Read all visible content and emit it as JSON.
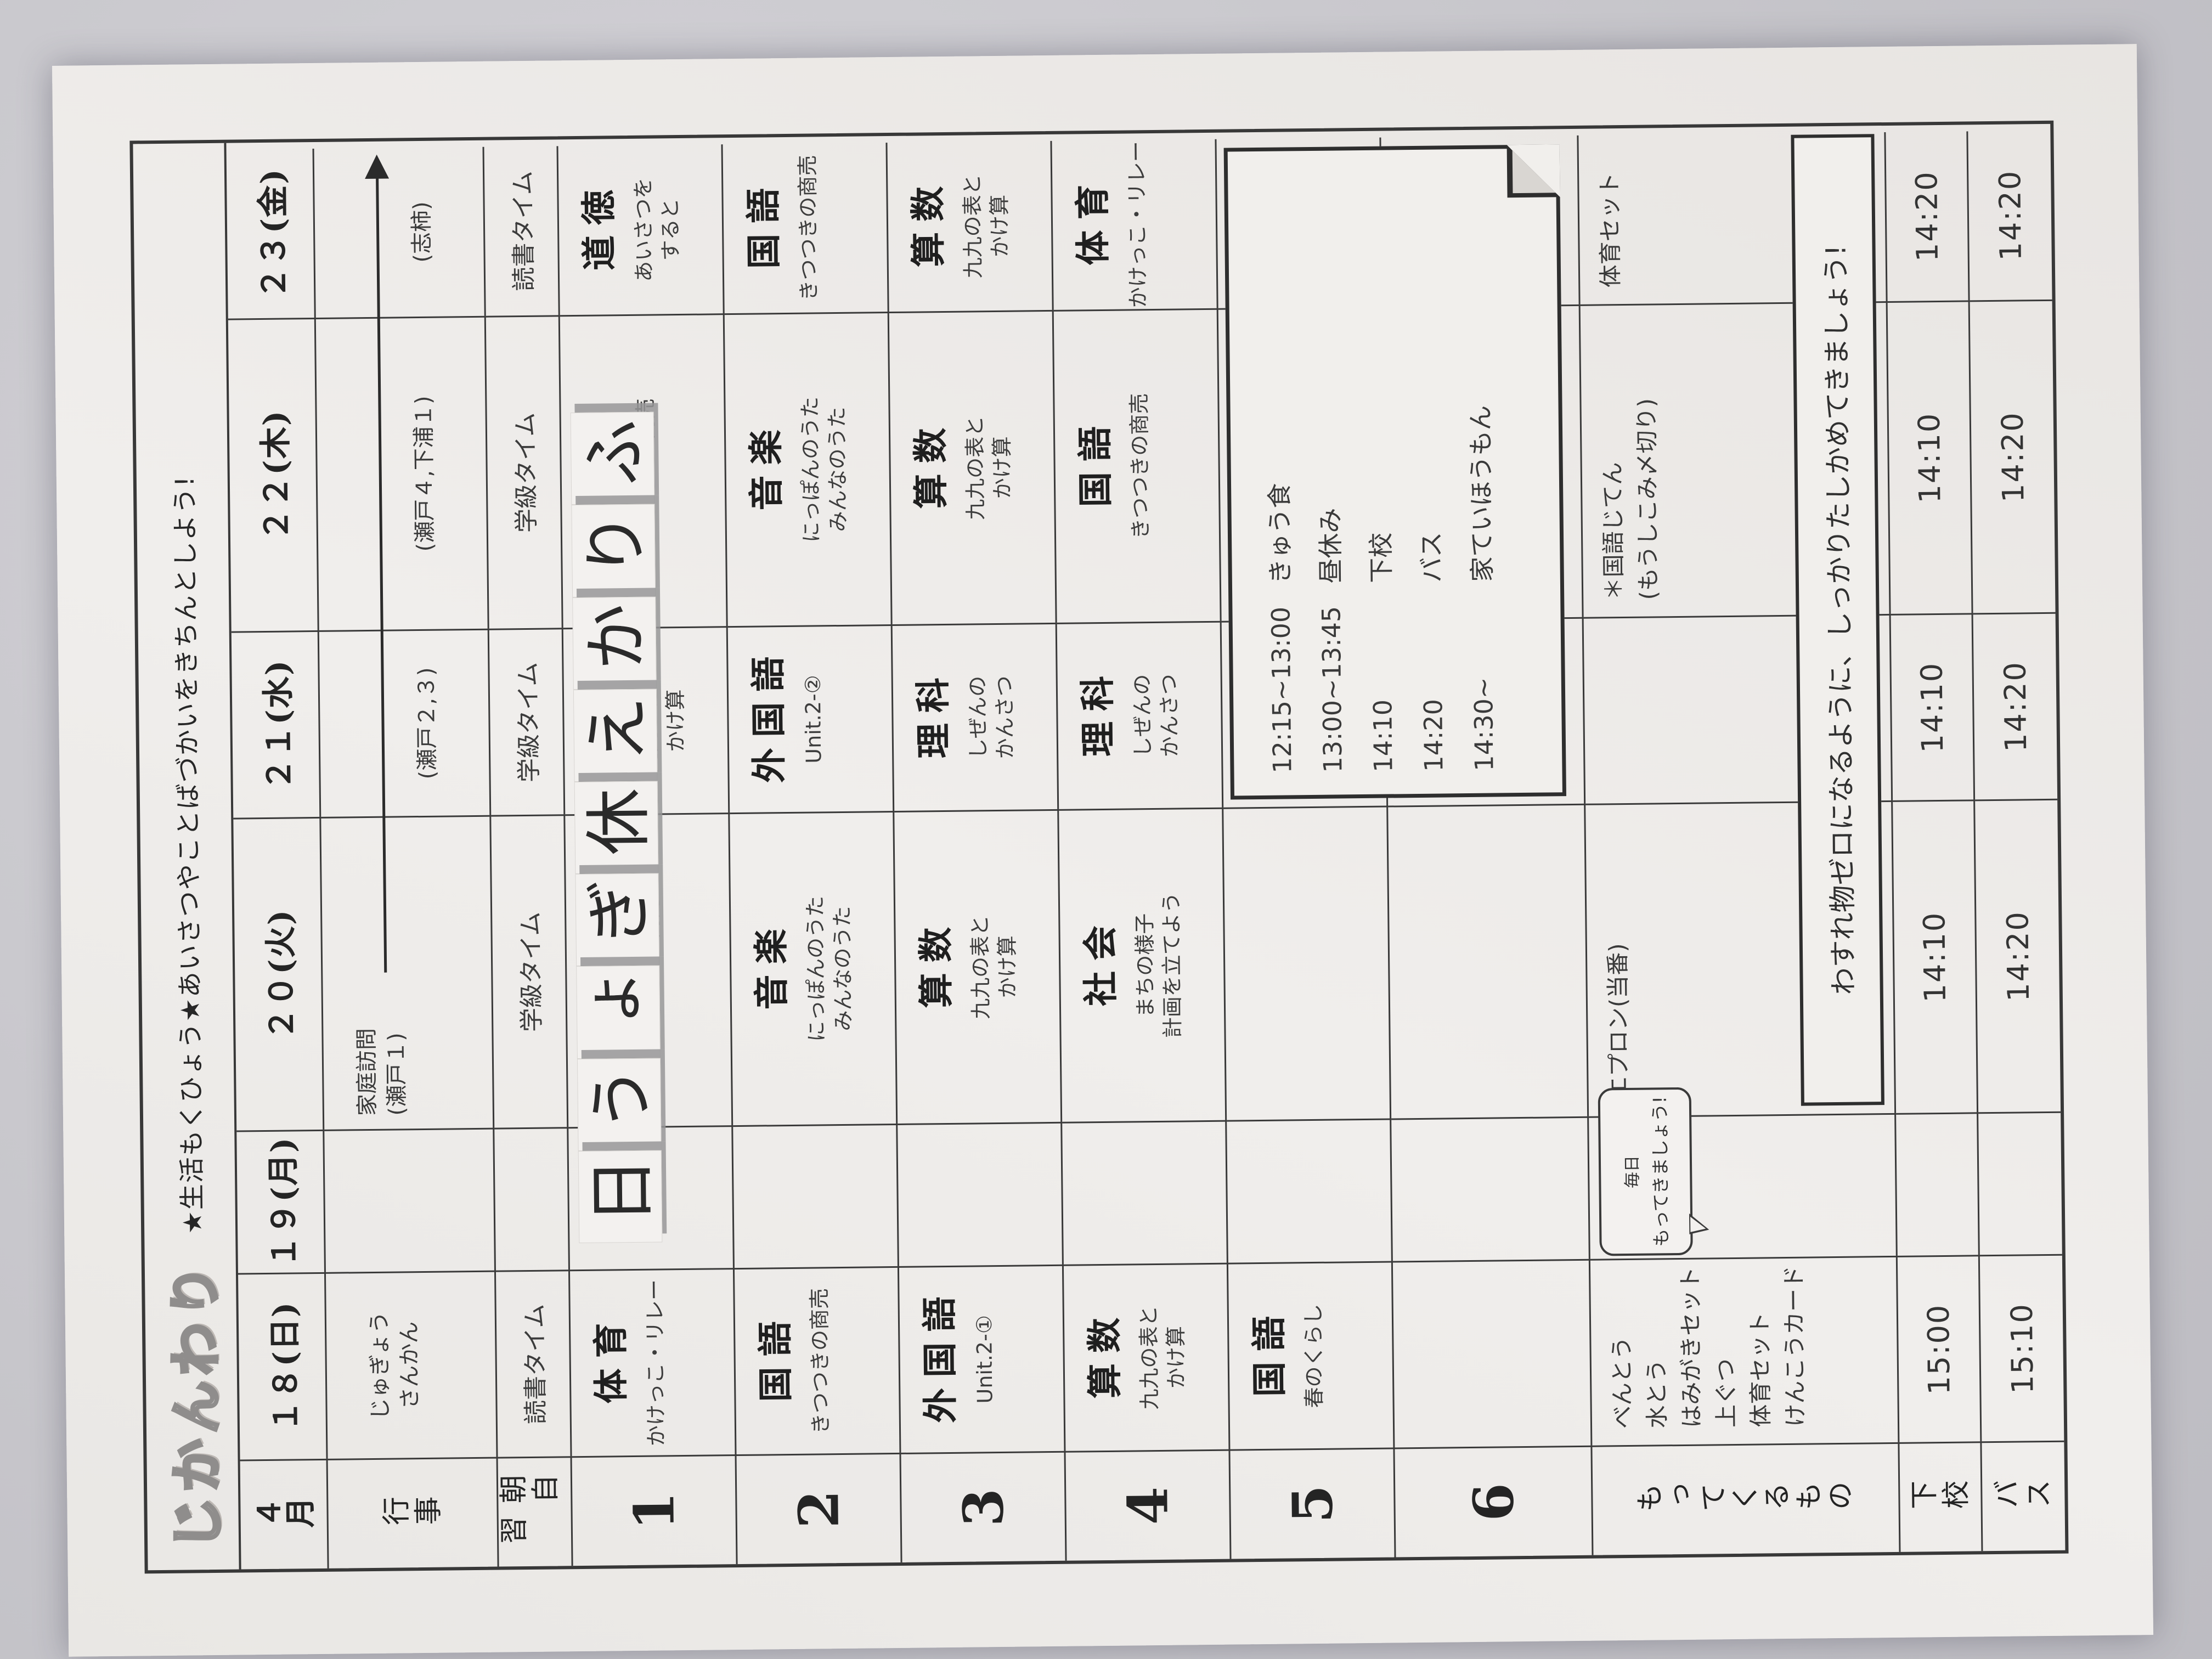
{
  "photo": {
    "background_color": "#c7c6cb",
    "paper_color": "#eeecea",
    "line_color": "#383838",
    "shadow_color": "#969698"
  },
  "title": {
    "logo": "じかんわり",
    "slogan": "★生活もくひょう★あいさつやことばづかいをきちんとしよう!"
  },
  "month_label": "４月",
  "row_labels": {
    "gyouji": "行事",
    "asa": "朝自習",
    "periods": [
      "1",
      "2",
      "3",
      "4",
      "5",
      "6"
    ],
    "motte": "もってくるもの",
    "gekou": "下校",
    "bus": "バス"
  },
  "holiday_overlay": "ふりかえ休ぎょう日",
  "days": [
    {
      "date": "１８(日)",
      "gyouji": [
        "じゅぎょう",
        "さんかん"
      ],
      "asa": "読書タイム",
      "periods": [
        {
          "subject": "体育",
          "topic": [
            "かけっこ・リレー"
          ]
        },
        {
          "subject": "国語",
          "topic": [
            "きつつきの商売"
          ]
        },
        {
          "subject": "外国語",
          "topic": [
            "Unit.2-①"
          ]
        },
        {
          "subject": "算数",
          "topic": [
            "九九の表と",
            "かけ算"
          ]
        },
        {
          "subject": "国語",
          "topic": [
            "春のくらし"
          ]
        },
        null
      ],
      "motte": [
        "べんとう",
        "水とう",
        "はみがきセット",
        "上ぐつ",
        "体育セット",
        "けんこうカード"
      ],
      "gekou": "15:00",
      "bus": "15:10"
    },
    {
      "date": "１９(月)",
      "gyouji": [],
      "asa": "",
      "periods": [
        null,
        null,
        null,
        null,
        null,
        null
      ],
      "motte": [],
      "gekou": "",
      "bus": ""
    },
    {
      "date": "２０(火)",
      "gyouji": [
        "家庭訪問",
        "(瀬戸１)"
      ],
      "asa": "学級タイム",
      "periods": [
        {
          "subject": "国語",
          "topic": [
            "きつつきの商売"
          ]
        },
        {
          "subject": "音楽",
          "topic": [
            "にっぽんのうた",
            "みんなのうた"
          ]
        },
        {
          "subject": "算数",
          "topic": [
            "九九の表と",
            "かけ算"
          ]
        },
        {
          "subject": "社会",
          "topic": [
            "まちの様子",
            "計画を立てよう"
          ]
        },
        null,
        null
      ],
      "motte": [
        "エプロン(当番)"
      ],
      "gekou": "14:10",
      "bus": "14:20"
    },
    {
      "date": "２１(水)",
      "gyouji": [
        "(瀬戸２,３)"
      ],
      "asa": "学級タイム",
      "periods": [
        {
          "subject": "算数",
          "topic": [
            "九九の表と",
            "かけ算"
          ]
        },
        {
          "subject": "外国語",
          "topic": [
            "Unit.2-②"
          ]
        },
        {
          "subject": "理科",
          "topic": [
            "しぜんの",
            "かんさつ"
          ]
        },
        {
          "subject": "理科",
          "topic": [
            "しぜんの",
            "かんさつ"
          ]
        },
        null,
        null
      ],
      "motte": [],
      "gekou": "14:10",
      "bus": "14:20"
    },
    {
      "date": "２２(木)",
      "gyouji": [
        "(瀬戸４,下浦１)"
      ],
      "asa": "学級タイム",
      "periods": [
        {
          "subject": "国語",
          "topic": [
            "きつつきの商売"
          ]
        },
        {
          "subject": "音楽",
          "topic": [
            "にっぽんのうた",
            "みんなのうた"
          ]
        },
        {
          "subject": "算数",
          "topic": [
            "九九の表と",
            "かけ算"
          ]
        },
        {
          "subject": "国語",
          "topic": [
            "きつつきの商売"
          ]
        },
        null,
        null
      ],
      "motte": [
        "＊国語じてん",
        "(もうしこみ〆切り)"
      ],
      "gekou": "14:10",
      "bus": "14:20"
    },
    {
      "date": "２３(金)",
      "gyouji": [
        "(志柿)"
      ],
      "asa": "読書タイム",
      "periods": [
        {
          "subject": "道徳",
          "topic": [
            "あいさつを",
            "すると"
          ]
        },
        {
          "subject": "国語",
          "topic": [
            "きつつきの商売"
          ]
        },
        {
          "subject": "算数",
          "topic": [
            "九九の表と",
            "かけ算"
          ]
        },
        {
          "subject": "体育",
          "topic": [
            "かけっこ・リレー"
          ]
        },
        null,
        null
      ],
      "motte": [
        "体育セット"
      ],
      "gekou": "14:20",
      "bus": "14:20"
    }
  ],
  "note_box": {
    "lines": [
      {
        "time": "12:15~13:00",
        "label": "きゅう食"
      },
      {
        "time": "13:00~13:45",
        "label": "昼休み"
      },
      {
        "time": "14:10",
        "label": "下校"
      },
      {
        "time": "14:20",
        "label": "バス"
      },
      {
        "time": "14:30~",
        "label": "家ていほうもん"
      }
    ]
  },
  "reminder_box": "わすれ物ゼロになるように、しっかりたしかめてきましょう!",
  "bubble": {
    "line1": "毎日",
    "line2": "もってきましょう!"
  }
}
